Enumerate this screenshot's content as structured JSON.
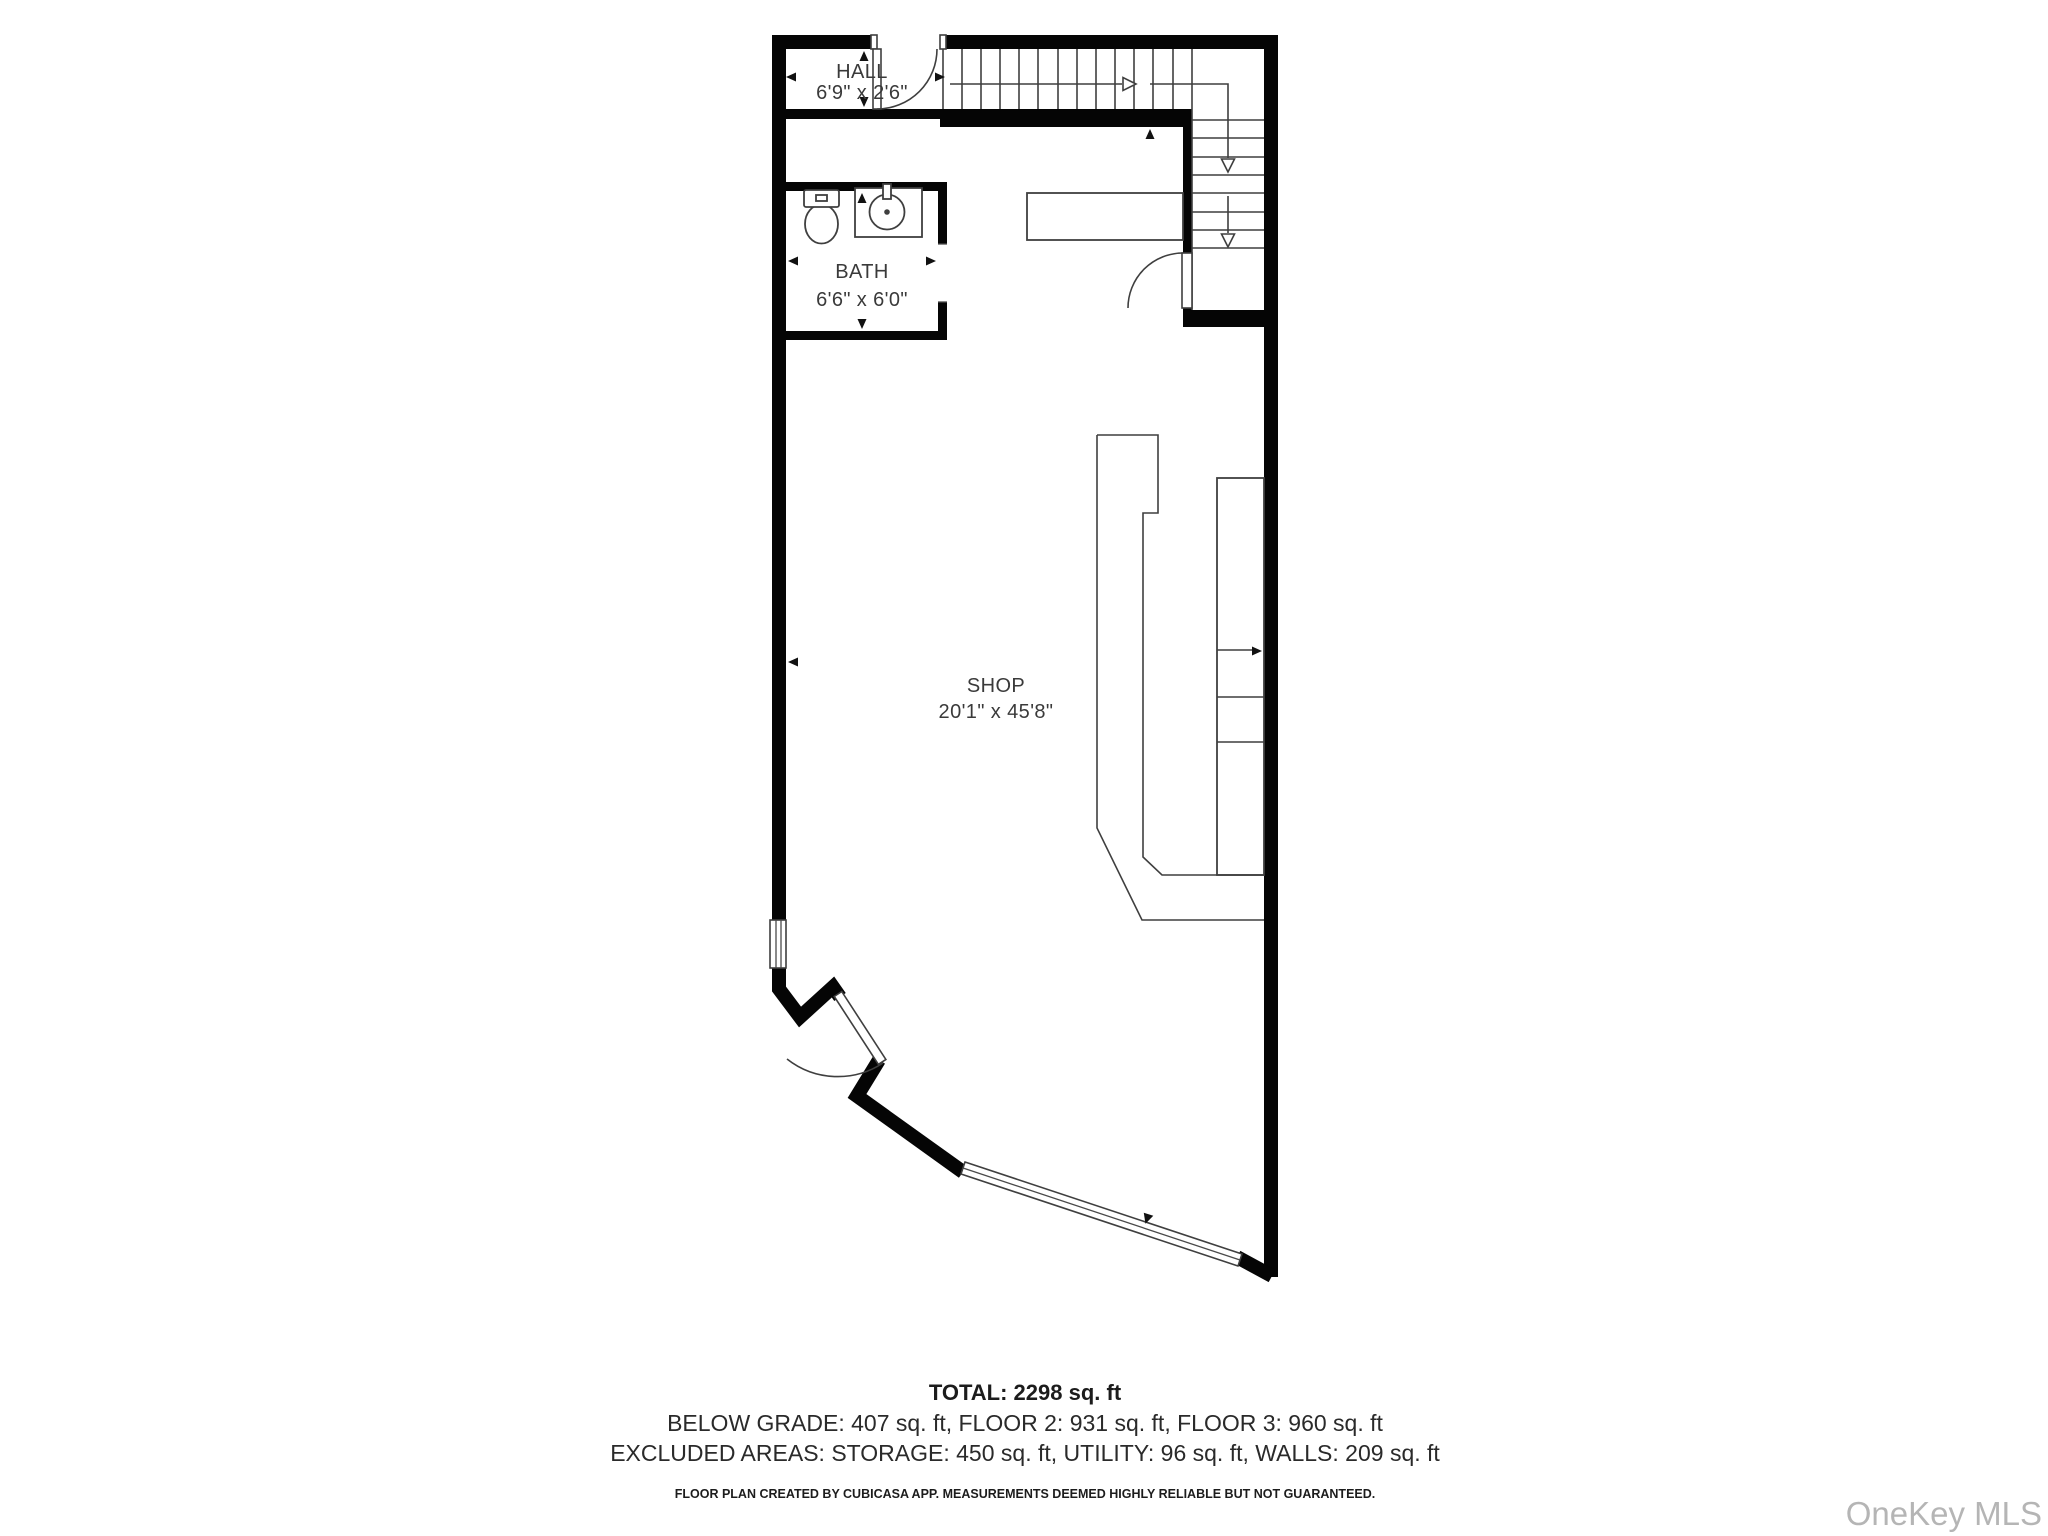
{
  "rooms": {
    "hall": {
      "name": "HALL",
      "dims": "6'9\" x 2'6\""
    },
    "bath": {
      "name": "BATH",
      "dims": "6'6\" x 6'0\""
    },
    "shop": {
      "name": "SHOP",
      "dims": "20'1\" x 45'8\""
    }
  },
  "summary": {
    "total": "TOTAL: 2298 sq. ft",
    "floors": "BELOW GRADE: 407 sq. ft, FLOOR 2: 931 sq. ft, FLOOR 3: 960 sq. ft",
    "excluded": "EXCLUDED AREAS: STORAGE: 450 sq. ft, UTILITY: 96 sq. ft, WALLS: 209 sq. ft",
    "disclaimer": "FLOOR PLAN CREATED BY CUBICASA APP. MEASUREMENTS DEEMED HIGHLY RELIABLE BUT NOT GUARANTEED."
  },
  "watermark": "OneKey MLS",
  "colors": {
    "wall": "#050505",
    "line": "#3f3f3f",
    "label": "#3a3a3a",
    "summary_text": "#1c1c1c",
    "watermark": "#b5b5b5"
  }
}
